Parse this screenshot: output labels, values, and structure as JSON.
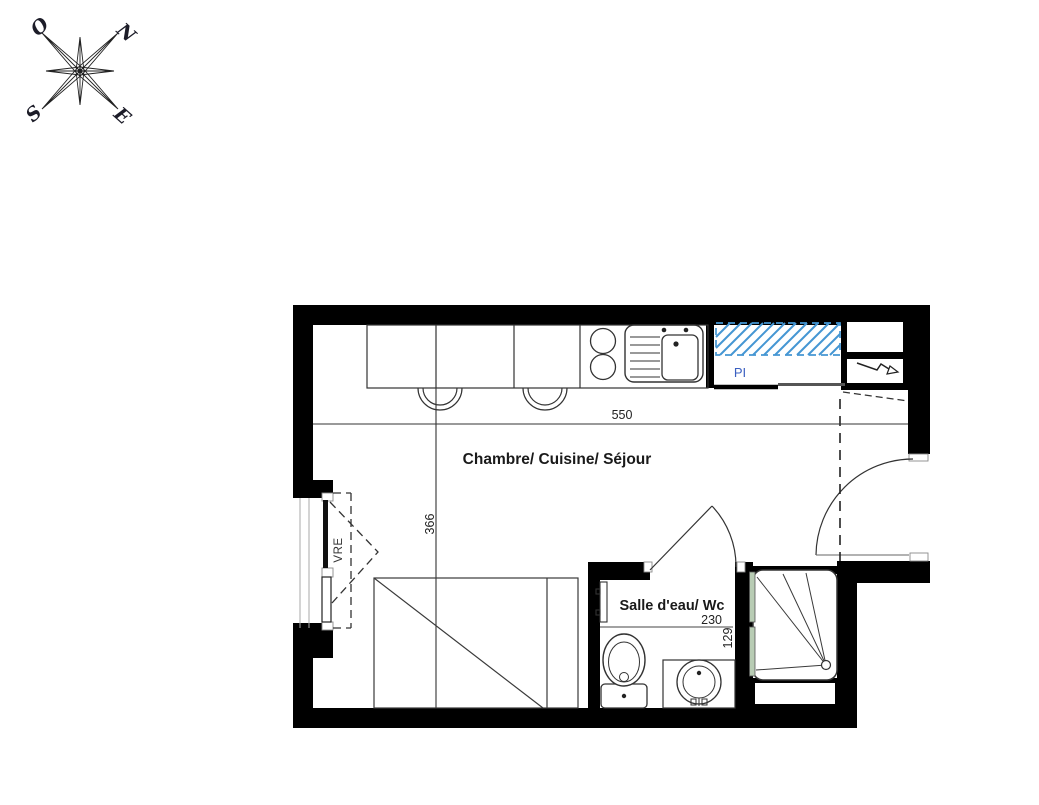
{
  "compass": {
    "north": "N",
    "west": "O",
    "south": "S",
    "east": "E"
  },
  "rooms": {
    "main_label": "Chambre/ Cuisine/ Séjour",
    "bathroom_label": "Salle d'eau/ Wc",
    "closet_label": "PI",
    "window_label": "VRE"
  },
  "dimensions": {
    "main_width_cm": "550",
    "main_depth_cm": "366",
    "bathroom_width_cm": "230",
    "bathroom_depth_cm": "129"
  },
  "colors": {
    "wall": "#000000",
    "line": "#333333",
    "hatch_blue": "#4596d3",
    "label_blue": "#3a5fc0",
    "glass_green": "#b8ccb4"
  }
}
